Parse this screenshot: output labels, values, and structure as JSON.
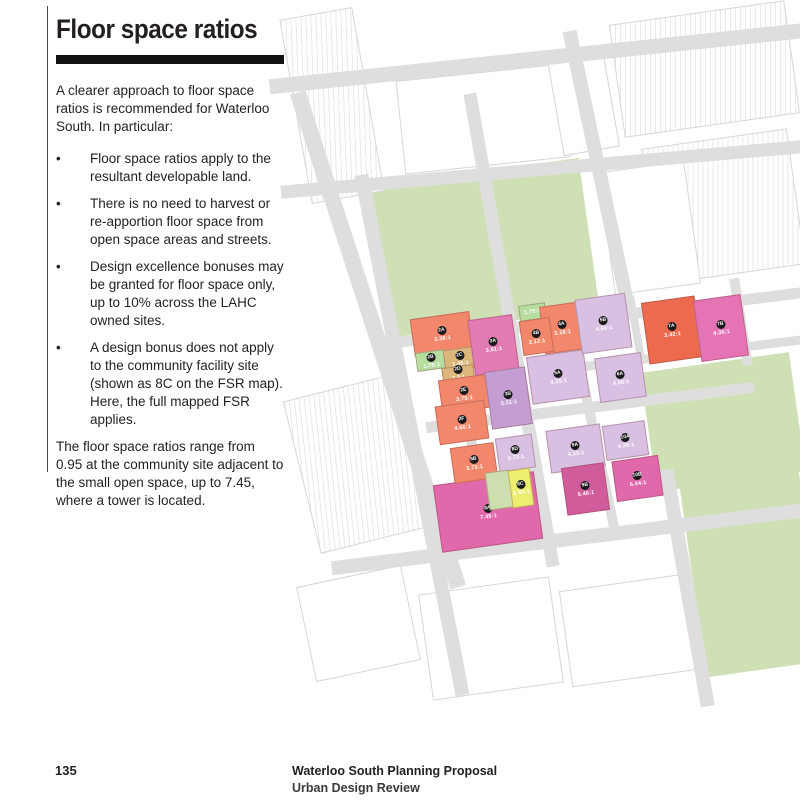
{
  "page": {
    "number": "135",
    "footer_line1": "Waterloo South Planning Proposal",
    "footer_line2": "Urban Design Review"
  },
  "article": {
    "title": "Floor space ratios",
    "intro": "A clearer approach to floor space ratios is recommended for Waterloo South.  In particular:",
    "bullet_glyph": "•",
    "bullets": [
      "Floor space ratios apply to the resultant developable land.",
      "There is no need to harvest or re-apportion floor space from open space areas and streets.",
      "Design excellence bonuses may be granted for floor space only, up to 10% across the LAHC owned sites.",
      "A design bonus does not apply to the community facility site (shown as 8C on the FSR map). Here, the full mapped FSR applies."
    ],
    "closing": "The floor space ratios range from 0.95 at the community site adjacent to the small open space, up to 7.45, where a tower is located."
  },
  "map": {
    "colors": {
      "road": "#dedede",
      "park": "#cfe0b5",
      "boundary": "#c23b2e",
      "salmon": "#f2876c",
      "red": "#ec6a4e",
      "green": "#b7dc9f",
      "tan": "#dcb77c",
      "pink": "#e27ab4",
      "hotpink": "#e068ab",
      "darkpink": "#d15c9c",
      "purple": "#c49ed2",
      "lightpurple": "#d9c0e3",
      "yellow": "#eded6f",
      "palegreen": "#cddfae"
    },
    "parks": [
      {
        "x": 378,
        "y": 172,
        "w": 212,
        "h": 152,
        "r": -8
      },
      {
        "x": 648,
        "y": 362,
        "w": 150,
        "h": 120,
        "r": -8
      },
      {
        "x": 692,
        "y": 470,
        "w": 120,
        "h": 200,
        "r": -8
      }
    ],
    "buildings": [
      {
        "x": 295,
        "y": 12,
        "w": 72,
        "h": 185,
        "r": -10,
        "hatch": true
      },
      {
        "x": 616,
        "y": 12,
        "w": 175,
        "h": 112,
        "r": -8,
        "hatch": true
      },
      {
        "x": 650,
        "y": 138,
        "w": 145,
        "h": 135,
        "r": -8,
        "hatch": true
      },
      {
        "x": 400,
        "y": 72,
        "w": 165,
        "h": 92,
        "r": -6,
        "hatch": false
      },
      {
        "x": 606,
        "y": 166,
        "w": 85,
        "h": 122,
        "r": -8,
        "hatch": false
      },
      {
        "x": 555,
        "y": 55,
        "w": 55,
        "h": 95,
        "r": -10,
        "hatch": false
      },
      {
        "x": 300,
        "y": 385,
        "w": 115,
        "h": 155,
        "r": -14,
        "hatch": true
      },
      {
        "x": 425,
        "y": 585,
        "w": 130,
        "h": 105,
        "r": -8,
        "hatch": false
      },
      {
        "x": 565,
        "y": 582,
        "w": 125,
        "h": 95,
        "r": -8,
        "hatch": false
      },
      {
        "x": 305,
        "y": 575,
        "w": 105,
        "h": 95,
        "r": -12,
        "hatch": false
      }
    ],
    "roads": [
      {
        "n": "phillip-street",
        "x": 268,
        "y": 50,
        "w": 560,
        "h": 15,
        "r": -6
      },
      {
        "n": "raglan-street",
        "x": 280,
        "y": 162,
        "w": 545,
        "h": 13,
        "r": -5
      },
      {
        "n": "wellington-street",
        "x": 388,
        "y": 312,
        "w": 425,
        "h": 11,
        "r": -7
      },
      {
        "n": "reeve-kellick-street",
        "x": 550,
        "y": 350,
        "w": 265,
        "h": 9,
        "r": -7
      },
      {
        "n": "john-street",
        "x": 425,
        "y": 402,
        "w": 330,
        "h": 11,
        "r": -7
      },
      {
        "n": "mcevoy-street",
        "x": 330,
        "y": 532,
        "w": 480,
        "h": 14,
        "r": -7
      },
      {
        "n": "botany-road",
        "x": 370,
        "y": 80,
        "w": 16,
        "h": 520,
        "r": -18
      },
      {
        "n": "cope-street",
        "x": 405,
        "y": 170,
        "w": 14,
        "h": 530,
        "r": -11
      },
      {
        "n": "cooper-street",
        "x": 460,
        "y": 330,
        "w": 10,
        "h": 142,
        "r": -9
      },
      {
        "n": "george-street",
        "x": 505,
        "y": 90,
        "w": 13,
        "h": 480,
        "r": -10
      },
      {
        "n": "mead-street",
        "x": 592,
        "y": 353,
        "w": 10,
        "h": 188,
        "r": -12
      },
      {
        "n": "young-street",
        "x": 736,
        "y": 278,
        "w": 10,
        "h": 88,
        "r": -9
      },
      {
        "n": "lane",
        "x": 632,
        "y": 296,
        "w": 8,
        "h": 68,
        "r": -10
      },
      {
        "n": "pitt-street-upper",
        "x": 592,
        "y": 28,
        "w": 14,
        "h": 284,
        "r": -12
      },
      {
        "n": "pitt-street-lower",
        "x": 680,
        "y": 468,
        "w": 14,
        "h": 240,
        "r": -10
      }
    ],
    "blocks": [
      {
        "id": "2A",
        "fsr": "3.36:1",
        "x": 412,
        "y": 315,
        "w": 58,
        "h": 36,
        "c": "#f2876c"
      },
      {
        "id": "2B",
        "fsr": "1.75:1",
        "x": 416,
        "y": 351,
        "w": 28,
        "h": 17,
        "c": "#b7dc9f"
      },
      {
        "id": "2C",
        "fsr": "1.45:1",
        "x": 444,
        "y": 348,
        "w": 30,
        "h": 20,
        "c": "#dcb77c"
      },
      {
        "id": "2D",
        "fsr": "2.2:1",
        "x": 442,
        "y": 366,
        "w": 30,
        "h": 11,
        "c": "#dcb77c"
      },
      {
        "id": "2E",
        "fsr": "3.75:1",
        "x": 440,
        "y": 377,
        "w": 46,
        "h": 32,
        "c": "#f2876c"
      },
      {
        "id": "2F",
        "fsr": "4.66:1",
        "x": 437,
        "y": 403,
        "w": 48,
        "h": 37,
        "c": "#f2876c"
      },
      {
        "id": "3A",
        "fsr": "3.81:1",
        "x": 471,
        "y": 317,
        "w": 43,
        "h": 54,
        "c": "#e27ab4"
      },
      {
        "id": "3B",
        "fsr": "3.31:1",
        "x": 488,
        "y": 369,
        "w": 39,
        "h": 56,
        "c": "#c49ed2"
      },
      {
        "id": "",
        "fsr": "1.75:1",
        "x": 519,
        "y": 304,
        "w": 25,
        "h": 14,
        "c": "#b7dc9f"
      },
      {
        "id": "4A",
        "fsr": "3.18:1",
        "x": 542,
        "y": 304,
        "w": 38,
        "h": 46,
        "c": "#f2876c"
      },
      {
        "id": "4B",
        "fsr": "2.12:1",
        "x": 521,
        "y": 319,
        "w": 29,
        "h": 33,
        "c": "#f2876c"
      },
      {
        "id": "5A",
        "fsr": "4.35:1",
        "x": 529,
        "y": 353,
        "w": 56,
        "h": 46,
        "c": "#d9c0e3"
      },
      {
        "id": "5B",
        "fsr": "4.66:1",
        "x": 578,
        "y": 296,
        "w": 49,
        "h": 53,
        "c": "#d9c0e3"
      },
      {
        "id": "6A",
        "fsr": "4.86:1",
        "x": 597,
        "y": 355,
        "w": 45,
        "h": 43,
        "c": "#d9c0e3"
      },
      {
        "id": "7A",
        "fsr": "3.42:1",
        "x": 645,
        "y": 299,
        "w": 52,
        "h": 60,
        "c": "#ec6a4e"
      },
      {
        "id": "7B",
        "fsr": "4.36:1",
        "x": 697,
        "y": 297,
        "w": 46,
        "h": 60,
        "c": "#e574b5"
      },
      {
        "id": "8A",
        "fsr": "7.45:1",
        "x": 437,
        "y": 478,
        "w": 100,
        "h": 66,
        "c": "#e068ab"
      },
      {
        "id": "8B",
        "fsr": "3.73:1",
        "x": 452,
        "y": 445,
        "w": 42,
        "h": 34,
        "c": "#f2876c"
      },
      {
        "id": "8D",
        "fsr": "4.73:1",
        "x": 497,
        "y": 436,
        "w": 35,
        "h": 32,
        "c": "#d9c0e3"
      },
      {
        "id": "",
        "fsr": "",
        "x": 487,
        "y": 471,
        "w": 23,
        "h": 36,
        "c": "#cddfae"
      },
      {
        "id": "8C",
        "fsr": "0.95:1",
        "x": 510,
        "y": 469,
        "w": 20,
        "h": 36,
        "c": "#eded6f"
      },
      {
        "id": "9A",
        "fsr": "4.13:1",
        "x": 548,
        "y": 427,
        "w": 53,
        "h": 41,
        "c": "#d9c0e3"
      },
      {
        "id": "9B",
        "fsr": "6.46:1",
        "x": 564,
        "y": 465,
        "w": 41,
        "h": 46,
        "c": "#d15c9c"
      },
      {
        "id": "10A",
        "fsr": "4.36:1",
        "x": 604,
        "y": 423,
        "w": 41,
        "h": 33,
        "c": "#d9c0e3"
      },
      {
        "id": "10B",
        "fsr": "6.44:1",
        "x": 614,
        "y": 458,
        "w": 45,
        "h": 39,
        "c": "#e068ab"
      }
    ],
    "streets": [
      {
        "t": "PHILLIP",
        "x": 342,
        "y": 58,
        "r": -6
      },
      {
        "t": "STREET",
        "x": 470,
        "y": 48,
        "r": -6
      },
      {
        "t": "RAGLAN  STREET",
        "x": 370,
        "y": 162,
        "r": -5
      },
      {
        "t": "BOTANY ROAD",
        "x": 293,
        "y": 188,
        "r": 68
      },
      {
        "t": "COPE STREET",
        "x": 352,
        "y": 184,
        "r": 78
      },
      {
        "t": "GEORGE STREET",
        "x": 484,
        "y": 178,
        "r": 80
      },
      {
        "t": "PITT STREET",
        "x": 604,
        "y": 232,
        "r": -78
      },
      {
        "t": "WELLINGTON  STREET",
        "x": 414,
        "y": 328,
        "r": -7
      },
      {
        "t": "WELLINGTON STREET",
        "x": 632,
        "y": 294,
        "r": -6
      },
      {
        "t": "REEVE STREET",
        "x": 592,
        "y": 357,
        "r": -7
      },
      {
        "t": "KELLICK  STREET",
        "x": 654,
        "y": 363,
        "r": -7
      },
      {
        "t": "YOUNG STREET",
        "x": 750,
        "y": 292,
        "r": 82
      },
      {
        "t": "COPE  STREET",
        "x": 414,
        "y": 398,
        "r": 78
      },
      {
        "t": "COOPER STREET",
        "x": 465,
        "y": 336,
        "r": 81
      },
      {
        "t": "GEORGE STREET",
        "x": 508,
        "y": 324,
        "r": 81
      },
      {
        "t": "MEAD STREET",
        "x": 596,
        "y": 444,
        "r": 78
      },
      {
        "t": "JOHN  STREET",
        "x": 544,
        "y": 421,
        "r": -7
      },
      {
        "t": "GEORGE STREET",
        "x": 538,
        "y": 448,
        "r": 80
      },
      {
        "t": "BOTANY ROAD",
        "x": 396,
        "y": 492,
        "r": 68
      },
      {
        "t": "MCEVOY  STREET",
        "x": 494,
        "y": 549,
        "r": -7
      },
      {
        "t": "PITT STREET",
        "x": 666,
        "y": 598,
        "r": -78
      }
    ],
    "boundary_points": "372,172 592,160 610,296 740,283 753,356 650,372 668,512 692,524 437,560"
  }
}
